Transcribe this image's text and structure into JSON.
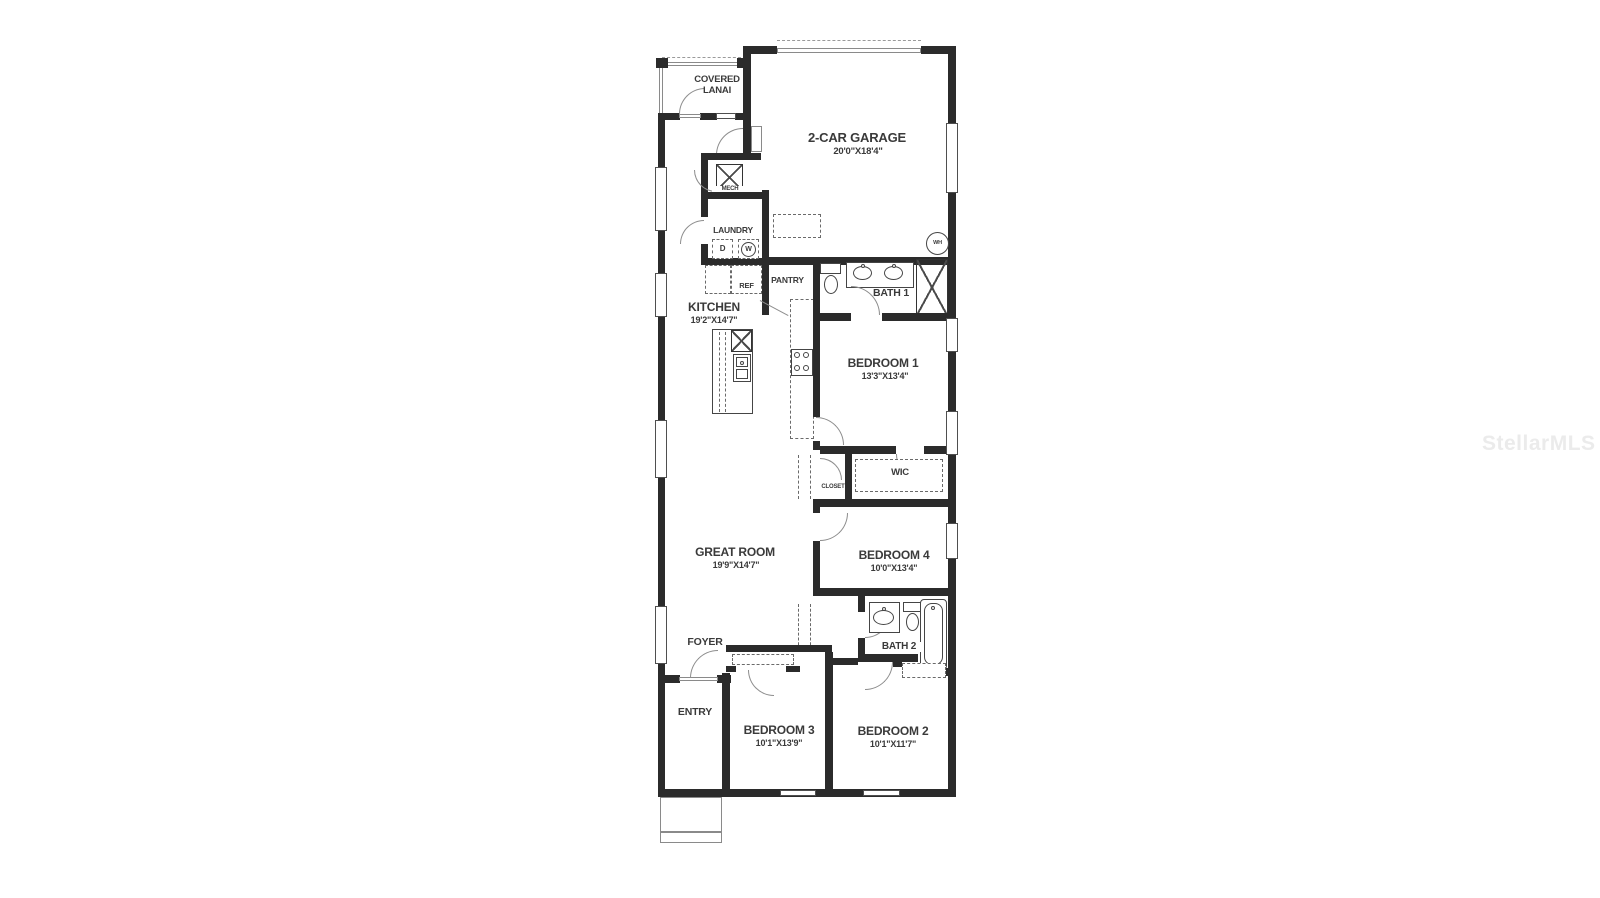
{
  "watermark": "StellarMLS",
  "rooms": {
    "covered_lanai": {
      "line1": "COVERED",
      "line2": "LANAI"
    },
    "garage": {
      "name": "2-CAR GARAGE",
      "dims": "20'0\"X18'4\""
    },
    "kitchen": {
      "name": "KITCHEN",
      "dims": "19'2\"X14'7\""
    },
    "great_room": {
      "name": "GREAT ROOM",
      "dims": "19'9\"X14'7\""
    },
    "bedroom1": {
      "name": "BEDROOM 1",
      "dims": "13'3\"X13'4\""
    },
    "bedroom2": {
      "name": "BEDROOM 2",
      "dims": "10'1\"X11'7\""
    },
    "bedroom3": {
      "name": "BEDROOM 3",
      "dims": "10'1\"X13'9\""
    },
    "bedroom4": {
      "name": "BEDROOM 4",
      "dims": "10'0\"X13'4\""
    },
    "bath1": {
      "name": "BATH 1"
    },
    "bath2": {
      "name": "BATH 2"
    },
    "foyer": {
      "name": "FOYER"
    },
    "entry": {
      "name": "ENTRY"
    },
    "wic": {
      "name": "WIC"
    },
    "closet": {
      "name": "CLOSET"
    },
    "laundry": {
      "name": "LAUNDRY"
    },
    "mech": {
      "name": "MECH"
    },
    "pantry": {
      "name": "PANTRY"
    },
    "ref": {
      "name": "REF"
    }
  },
  "appliances": {
    "dryer": "D",
    "washer": "W",
    "water_heater": "WH"
  }
}
